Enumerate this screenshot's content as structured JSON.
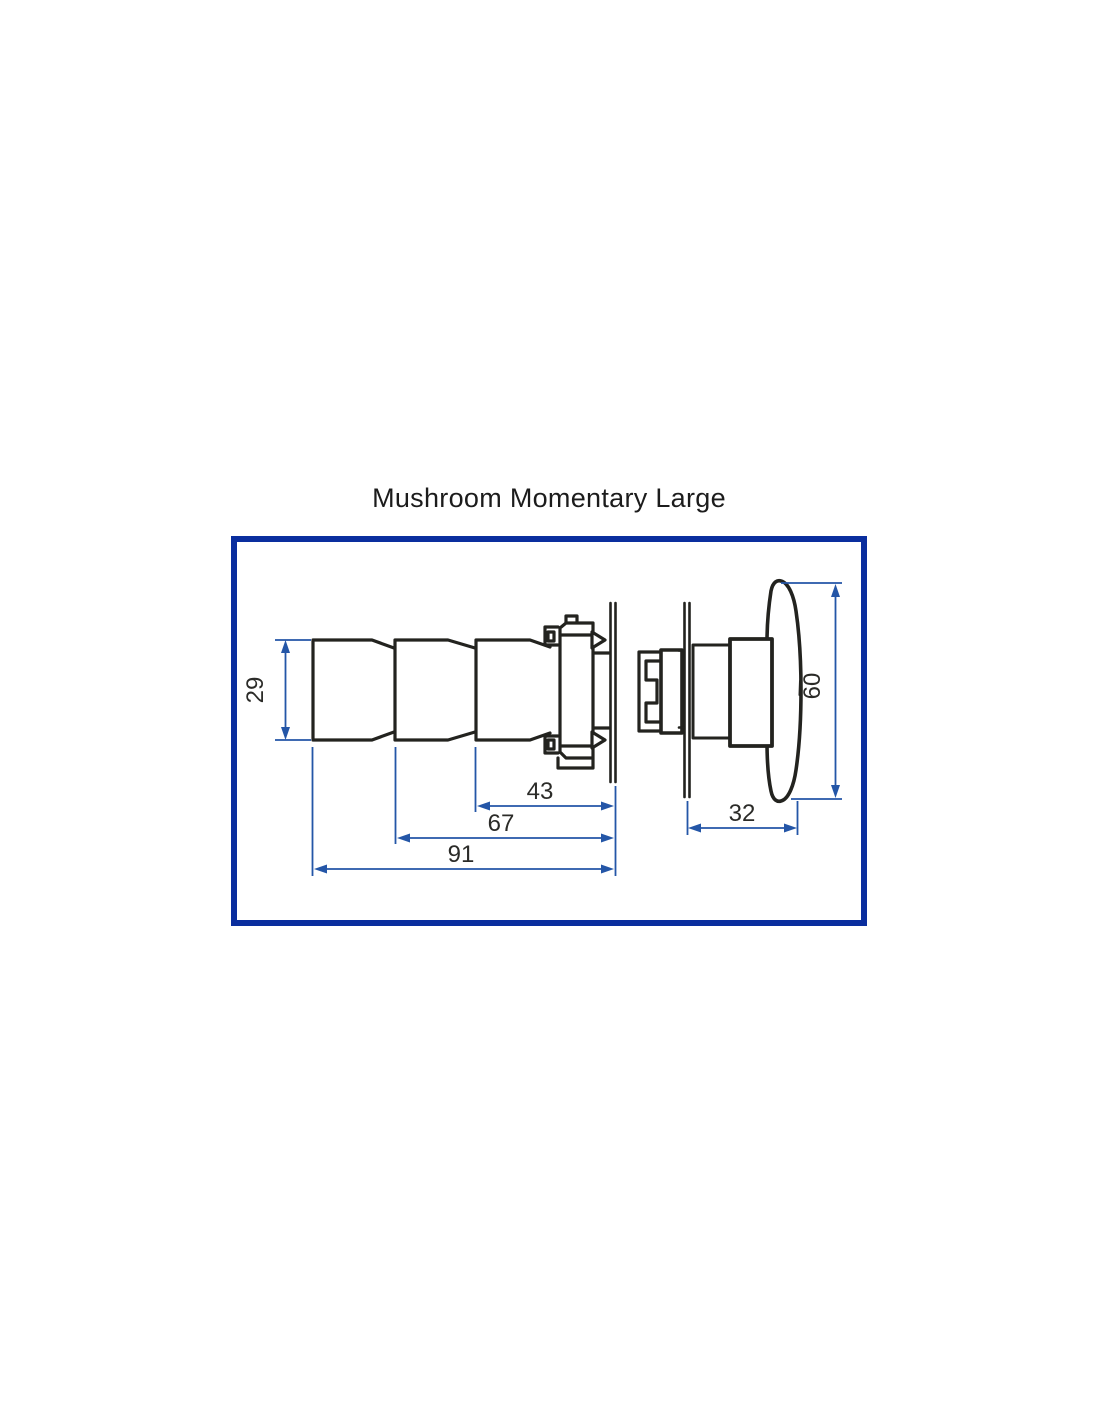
{
  "title": "Mushroom Momentary Large",
  "diagram": {
    "type": "technical-dimension-drawing",
    "subject": "mushroom momentary pushbutton, large, side views with panel",
    "views": [
      {
        "name": "body-side-view",
        "dimensions": [
          {
            "id": "body-height",
            "value": "29",
            "orientation": "vertical"
          },
          {
            "id": "front-section-length",
            "value": "43",
            "orientation": "horizontal"
          },
          {
            "id": "mid-section-length",
            "value": "67",
            "orientation": "horizontal"
          },
          {
            "id": "overall-length",
            "value": "91",
            "orientation": "horizontal"
          }
        ]
      },
      {
        "name": "head-side-view",
        "dimensions": [
          {
            "id": "cap-height",
            "value": "60",
            "orientation": "vertical"
          },
          {
            "id": "head-projection",
            "value": "32",
            "orientation": "horizontal"
          }
        ]
      }
    ]
  },
  "colors": {
    "frame_navy": "#0a2e9e",
    "dimension_blue": "#2456a7",
    "drawing_black": "#23231f",
    "label_dark": "#2b2b28",
    "title_dark": "#1c1c1c",
    "background": "#ffffff"
  }
}
